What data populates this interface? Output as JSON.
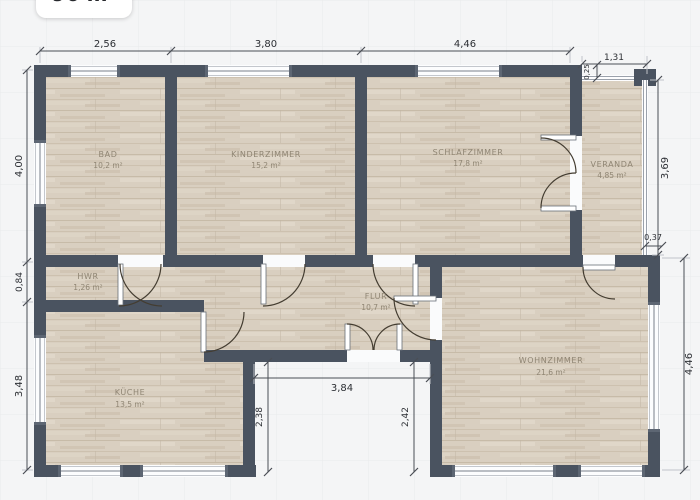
{
  "badge": {
    "total_area": "96 m²"
  },
  "rooms": [
    {
      "name": "BAD",
      "area": "10,2 m²"
    },
    {
      "name": "KINDERZIMMER",
      "area": "15,2 m²"
    },
    {
      "name": "SCHLAFZIMMER",
      "area": "17,8 m²"
    },
    {
      "name": "VERANDA",
      "area": "4,85 m²"
    },
    {
      "name": "HWR",
      "area": "1,26 m²"
    },
    {
      "name": "FLUR",
      "area": "10,7 m²"
    },
    {
      "name": "KÜCHE",
      "area": "13,5 m²"
    },
    {
      "name": "WOHNZIMMER",
      "area": "21,6 m²"
    }
  ],
  "dimensions": {
    "top": [
      "2,56",
      "3,80",
      "4,46",
      "1,31",
      "0,25"
    ],
    "left": [
      "4,00",
      "0,84",
      "3,48"
    ],
    "right": [
      "3,69",
      "0,37",
      "4,46"
    ],
    "bottom": [
      "3,84",
      "2,38",
      "2,42"
    ]
  },
  "colors": {
    "wall": "#4a5360",
    "floor": "#d9cfc0",
    "background": "#f4f5f6",
    "dimension_line": "#4a4e55",
    "room_label": "#8f8573"
  }
}
